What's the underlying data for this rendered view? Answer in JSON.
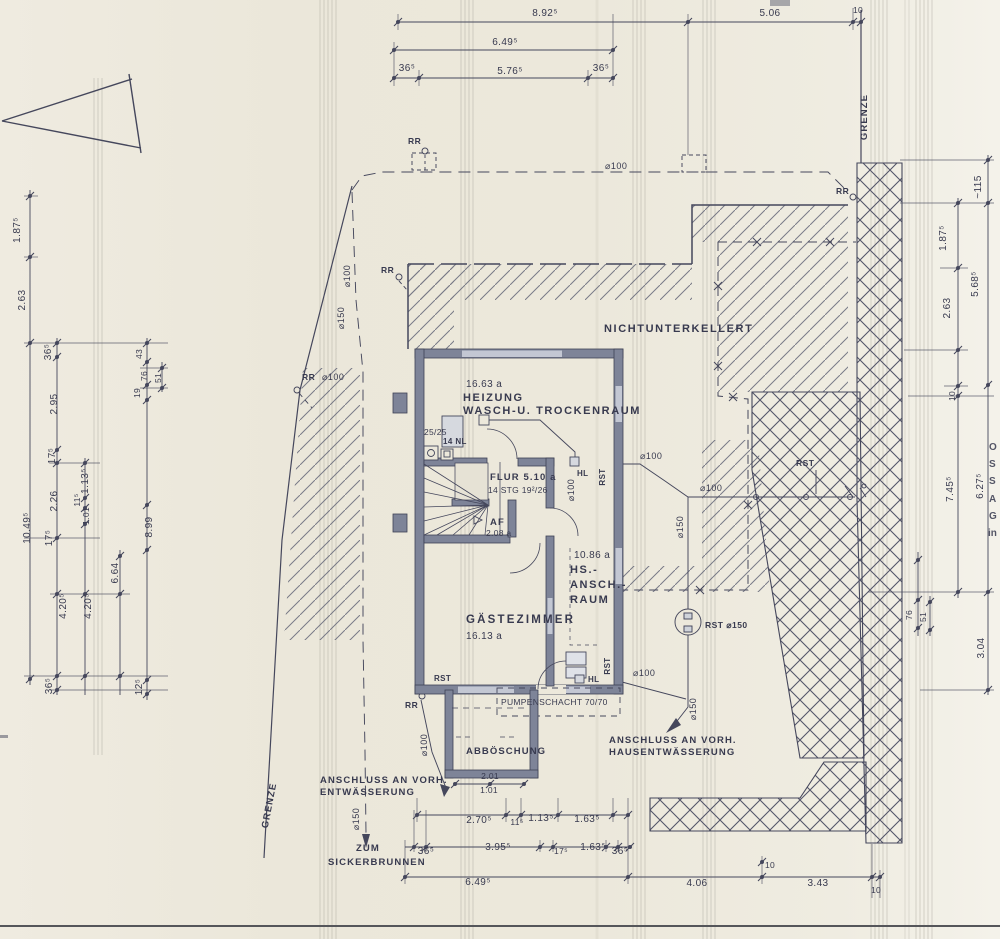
{
  "site": {
    "nichtunterkellert": "NICHTUNTERKELLERT",
    "anschluss_haus_line1": "ANSCHLUSS AN VORH.",
    "anschluss_haus_line2": "HAUSENTWÄSSERUNG",
    "anschluss_ent_line1": "ANSCHLUSS AN VORH.",
    "anschluss_ent_line2": "ENTWÄSSERUNG",
    "zum": "ZUM",
    "sickerbrunnen": "SICKERBRUNNEN",
    "rst_d150": "RST ⌀150",
    "grenze": "GRENZE"
  },
  "rooms": {
    "heizung_area": "16.63 a",
    "heizung_line1": "HEIZUNG",
    "heizung_line2": "WASCH-U. TROCKENRAUM",
    "chimney": "25/25",
    "chimney_sub": "14 NL",
    "flur": "FLUR 5.10 a",
    "stairs": "14 STG 19²/26",
    "af": "AF",
    "af_area": "2.08 a",
    "gaestezimmer": "GÄSTEZIMMER",
    "gaestezimmer_area": "16.13 a",
    "hs_area": "10.86 a",
    "hs_line1": "HS.-",
    "hs_line2": "ANSCH.-",
    "hs_line3": "RAUM",
    "pumpenschacht": "PUMPENSCHACHT 70/70",
    "abboeschung": "ABBÖSCHUNG"
  },
  "pipes": {
    "d100": "⌀100",
    "d150": "⌀150",
    "rr": "RR",
    "rst": "RST",
    "hl": "HL"
  },
  "dims": {
    "top": [
      "8.92⁵",
      "5.06",
      "10",
      "6.49⁵",
      "36⁵",
      "5.76⁵",
      "36⁵"
    ],
    "left": [
      "1.87⁵",
      "2.63",
      "36⁵",
      "2.95",
      "17⁵",
      "1.13⁵",
      "2.26",
      "11⁵",
      "1.01",
      "10.49⁵",
      "17⁵",
      "43",
      "76",
      "51",
      "19",
      "8.99",
      "6.64",
      "4.20⁵",
      "4.20⁵",
      "36⁵",
      "12⁵"
    ],
    "right": [
      "~115",
      "1.87⁵",
      "2.63",
      "5.68⁵",
      "10",
      "7.45⁵",
      "6.27⁵",
      "76",
      "51",
      "3.04"
    ],
    "bottom": [
      "2.70⁵",
      "11⁵",
      "1.13⁵",
      "1.63⁵",
      "36⁵",
      "3.95⁵",
      "17⁵",
      "1.63⁵",
      "36⁵",
      "6.49⁵",
      "10",
      "4.06",
      "3.43",
      "10",
      "2.01",
      "1.01"
    ]
  },
  "porch_dims": {
    "outer": "2.01",
    "inner": "1.01"
  },
  "stamp": {
    "letters": [
      "O",
      "S",
      "S",
      "A",
      "G",
      "in"
    ],
    "color": "#1f9fa8"
  },
  "colors": {
    "paper": "#ece8db",
    "ink": "#45475c",
    "wall": "#7e8498",
    "window": "#c3c7d3",
    "scanline": "#b3b0a5",
    "stamp_teal": "#1f9fa8"
  }
}
